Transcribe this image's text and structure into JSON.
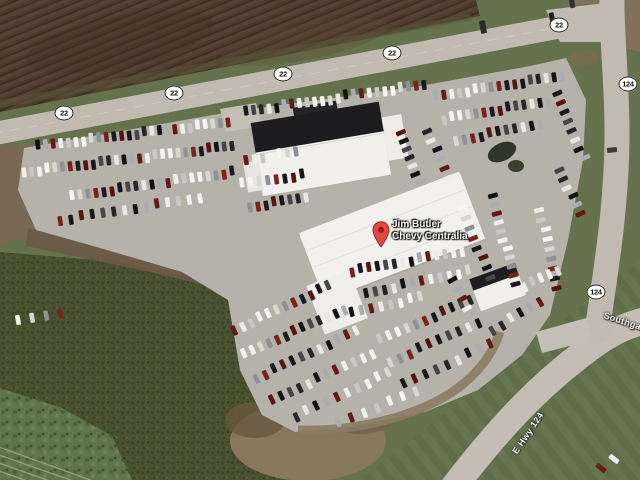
{
  "map_view": {
    "type": "satellite-aerial-photo",
    "place_marker": {
      "label_line1": "Jim Butler",
      "label_line2": "Chevy Centralia",
      "pin_color": "#e4453c",
      "pin_dot_color": "#8e2020"
    },
    "route_shields": {
      "style": {
        "background": "#fbfbf7",
        "border": "#1f1f1f",
        "text": "#141414"
      },
      "items": [
        {
          "route": "22"
        },
        {
          "route": "22"
        },
        {
          "route": "22"
        },
        {
          "route": "22"
        },
        {
          "route": "22"
        },
        {
          "route": "124"
        },
        {
          "route": "124"
        }
      ]
    },
    "road_labels": [
      {
        "text": "E Hwy 124"
      },
      {
        "text": "Southgate"
      }
    ],
    "terrain_colors": {
      "grass": "#66744e",
      "farm_field": "#4b382c",
      "scrub": "#49512f",
      "pavement": "#b6b2aa",
      "road": "#c1bbb1",
      "dirt": "#89785d",
      "building_white": "#f3f2ee",
      "roof_dark": "#1c1c1f"
    }
  }
}
